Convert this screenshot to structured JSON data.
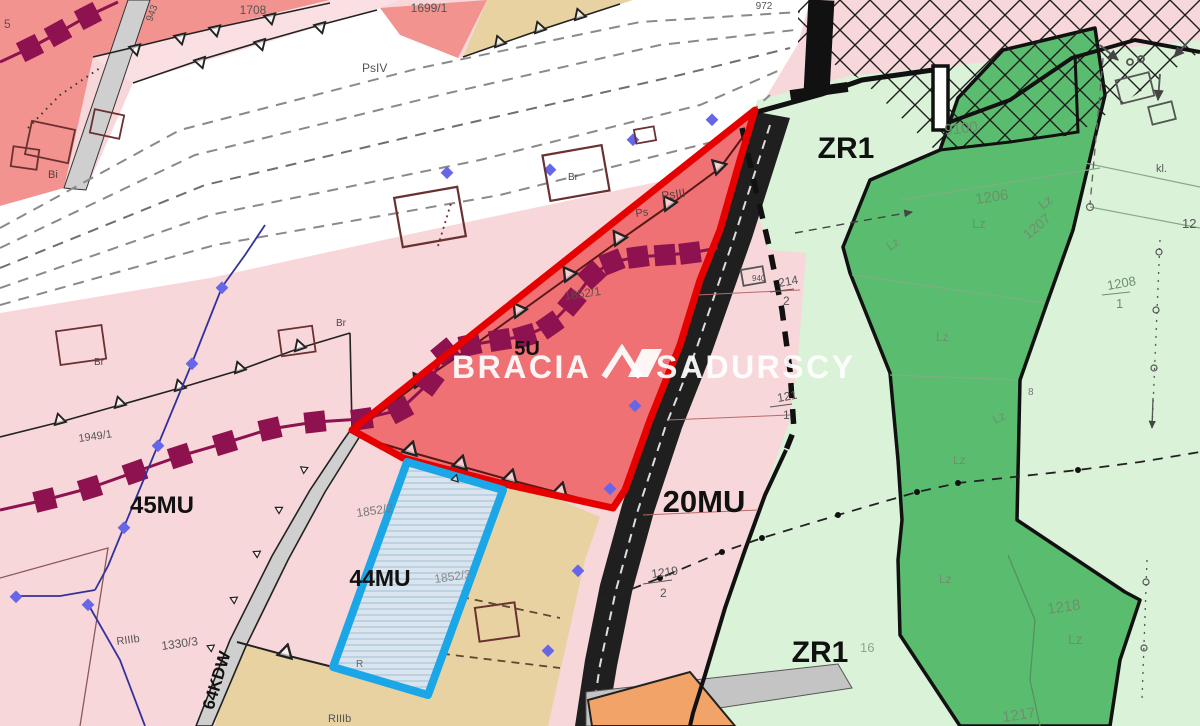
{
  "map": {
    "watermark": {
      "part1": "BRACIA",
      "part2": "SADURSCY",
      "logo_icon": "bracia-sadurscy-logo"
    },
    "zone_labels": {
      "zr1": "ZR1",
      "mu20": "20MU",
      "mu45": "45MU",
      "mu44": "44MU",
      "u5": "5U",
      "kdw64": "64KDW"
    },
    "parcel_labels": {
      "p1708": "1708",
      "p1699_1": "1699/1",
      "p972": "972",
      "p943": "943",
      "p5": "5",
      "psiv": "PsIV",
      "bi": "Bi",
      "br": "Br",
      "p1949_1": "1949/1",
      "p1330_3": "1330/3",
      "riiib": "RIIIb",
      "p1852_1": "1852/1",
      "p1852_2": "1852/2",
      "p1852_3": "1852/3",
      "r": "R",
      "psiii": "PsIII",
      "ps": "Ps",
      "p9100": "9100",
      "p1206": "1206",
      "lz": "Lz",
      "p1207": "1207",
      "p1208": "1208",
      "den1": "1",
      "p214": "214",
      "den2": "2",
      "p121": "121",
      "p1219": "1219",
      "p16": "16",
      "p1218": "1218",
      "p1217": "1217",
      "kl": "kl.",
      "p12": "12",
      "p940": "940",
      "p8": "8"
    },
    "colors": {
      "base_pink": "#f8d7da",
      "salmon": "#f29390",
      "wedge_pink": "#fadfe3",
      "tan": "#e8d2a2",
      "orange": "#f2a468",
      "white_road": "#ffffff",
      "gray_road": "#cfcfcf",
      "black_road": "#1f1f1f",
      "light_green": "#d9f2d8",
      "dark_green": "#5abc6e",
      "red_fill": "#ef7173",
      "highlight_red": "#e60000",
      "highlight_blue": "#1ba6e8",
      "blue_fill": "#d9e4ee",
      "purple_line": "#8e1250",
      "navy_line": "#32329b",
      "watermark": "#ffffff"
    }
  }
}
